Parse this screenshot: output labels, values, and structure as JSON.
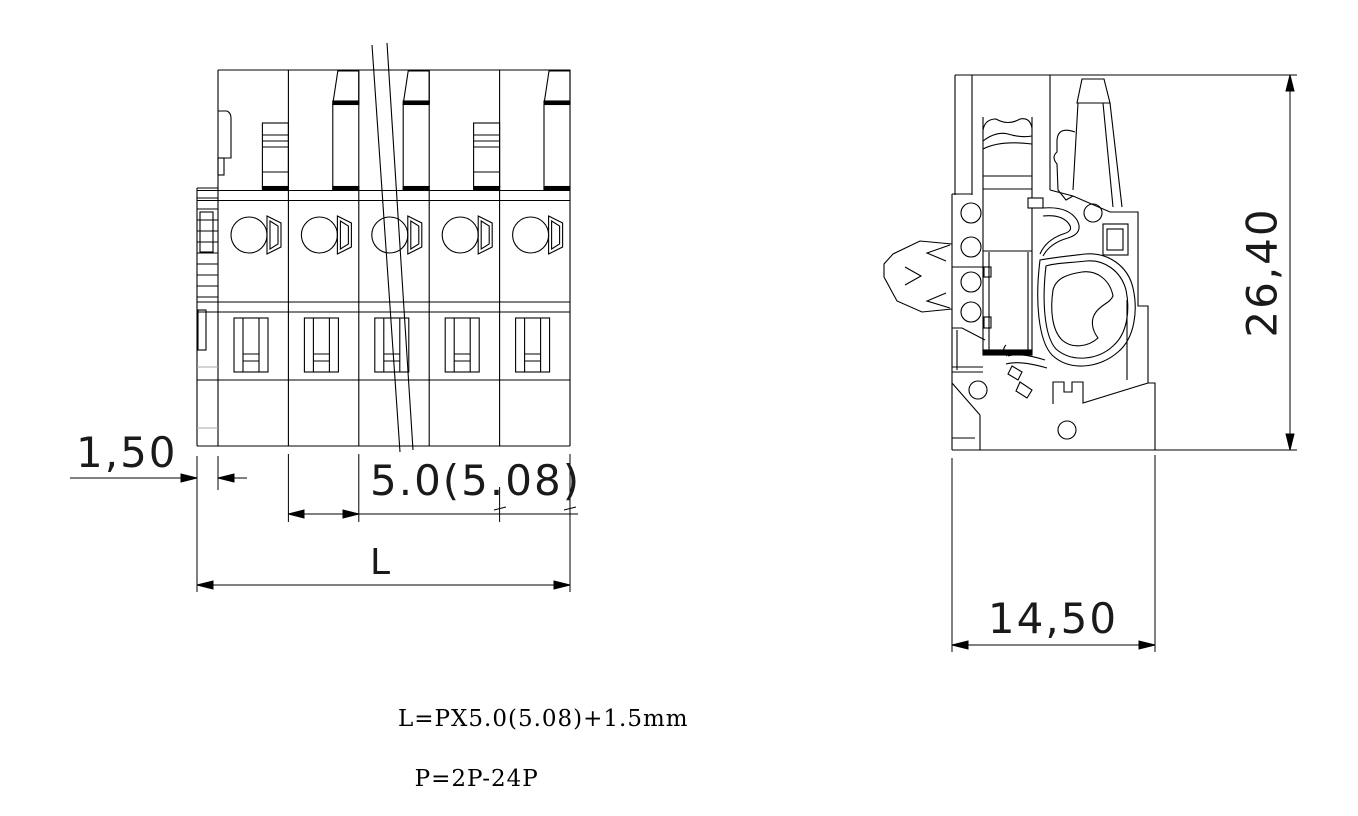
{
  "drawing": {
    "type": "engineering-drawing",
    "component": "pluggable terminal block connector",
    "views": {
      "front_view": "front view with 5 poles and length break lines",
      "side_view": "side cross-section view"
    },
    "line_color": "#000000",
    "background": "#ffffff"
  },
  "dimensions": {
    "rail_offset": {
      "value": "1,50"
    },
    "pitch": {
      "value": "5.0(5.08)"
    },
    "total_length": {
      "value": "L"
    },
    "height": {
      "value": "26,40"
    },
    "depth": {
      "value": "14,50"
    }
  },
  "notes": {
    "line1": "L=PX5.0(5.08)+1.5mm",
    "line2": "P=2P-24P"
  }
}
